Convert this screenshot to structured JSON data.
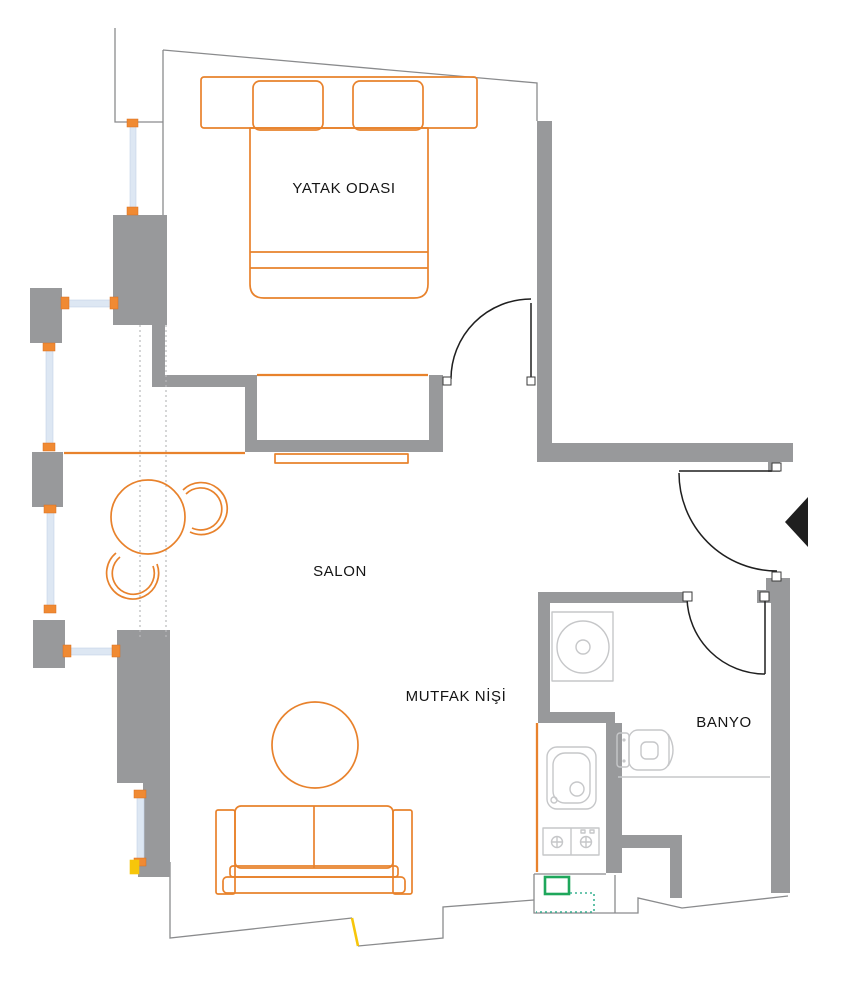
{
  "title": "Apartment floor plan",
  "rooms": {
    "bedroom": "YATAK ODASI",
    "living": "SALON",
    "kitchen": "MUTFAK NİŞİ",
    "bathroom": "BANYO"
  },
  "colors": {
    "wall": "#98999b",
    "outline": "#8a8b8d",
    "furniture": "#e8822c",
    "window-cap": "#f08a33",
    "glass": "#dde7f3",
    "fixture": "#c6c7c9",
    "door": "#1f1f1f",
    "arrow": "#1f1f1f",
    "text": "#141414",
    "green": "#1ea75b",
    "teal": "#3ab393",
    "yellow": "#f7c60a",
    "dots": "#b9babc"
  }
}
